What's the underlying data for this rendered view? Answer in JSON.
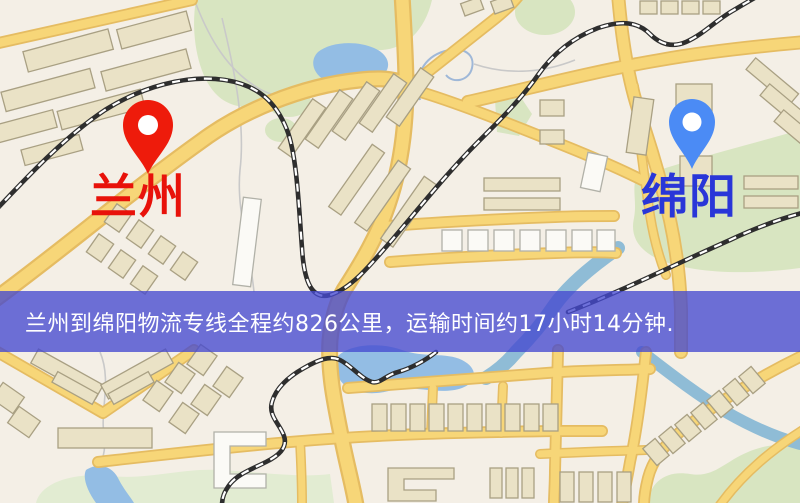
{
  "page": {
    "type": "logistics-route-map-screenshot"
  },
  "map": {
    "origin": {
      "name": "兰州"
    },
    "destination": {
      "name": "绵阳"
    },
    "banner": {
      "text": "兰州到绵阳物流专线全程约826公里，运输时间约17小时14分钟."
    },
    "route": {
      "distance": "约826公里",
      "duration": "约17小时14分钟"
    }
  },
  "colors": {
    "origin_pin": "#ee1b0b",
    "origin_label": "#e8120a",
    "destination_pin": "#4b8bf5",
    "destination_label": "#2936d8",
    "banner_overlay": "#4549d0",
    "banner_text": "#ffffff",
    "map_background": "#f4efe6",
    "road": "#f7d678",
    "road_casing": "#e5bc62",
    "park": "#d8e5c1",
    "water": "#93bde4",
    "railway": "#2e2e2e",
    "building": "#eae2c6"
  }
}
